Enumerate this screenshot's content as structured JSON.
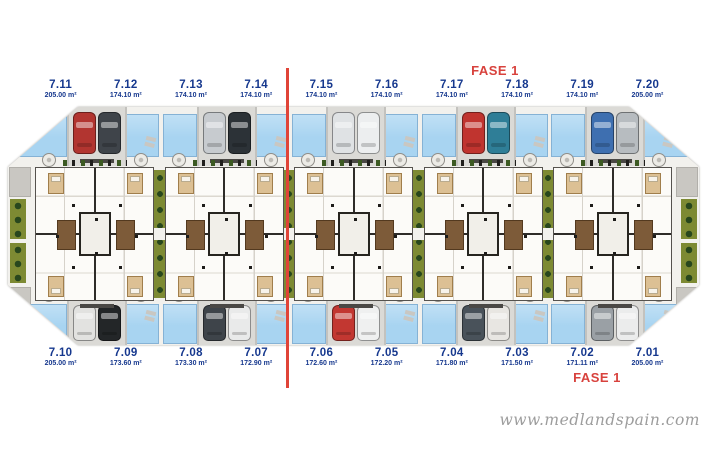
{
  "watermark": {
    "text": "www.medlandspain.com"
  },
  "phase": {
    "top": "FASE 1",
    "bottom": "FASE 1"
  },
  "colors": {
    "unit_label": "#16388e",
    "phase_text": "#d8423d",
    "phase_line": "#e04438",
    "pool": "#a8d4f1",
    "hedge": "#7d8a33",
    "plan_background": "#f2f1ed"
  },
  "blocks": {
    "count": 5
  },
  "units": {
    "top": [
      {
        "number": "7.11",
        "area": "205.00 m²"
      },
      {
        "number": "7.12",
        "area": "174.10 m²"
      },
      {
        "number": "7.13",
        "area": "174.10 m²"
      },
      {
        "number": "7.14",
        "area": "174.10 m²"
      },
      {
        "number": "7.15",
        "area": "174.10 m²"
      },
      {
        "number": "7.16",
        "area": "174.10 m²"
      },
      {
        "number": "7.17",
        "area": "174.10 m²"
      },
      {
        "number": "7.18",
        "area": "174.10 m²"
      },
      {
        "number": "7.19",
        "area": "174.10 m²"
      },
      {
        "number": "7.20",
        "area": "205.00 m²"
      }
    ],
    "bottom": [
      {
        "number": "7.10",
        "area": "205.00 m²"
      },
      {
        "number": "7.09",
        "area": "173.60 m²"
      },
      {
        "number": "7.08",
        "area": "173.30 m²"
      },
      {
        "number": "7.07",
        "area": "172.90 m²"
      },
      {
        "number": "7.06",
        "area": "172.60 m²"
      },
      {
        "number": "7.05",
        "area": "172.20 m²"
      },
      {
        "number": "7.04",
        "area": "171.80 m²"
      },
      {
        "number": "7.03",
        "area": "171.50 m²"
      },
      {
        "number": "7.02",
        "area": "171.11 m²"
      },
      {
        "number": "7.01",
        "area": "205.00 m²"
      }
    ]
  },
  "cars": {
    "top": [
      "#b23530",
      "#3f444a",
      "#c7cbcf",
      "#2c3237",
      "#dfe2e4",
      "#eceeef",
      "#c0342f",
      "#2f7e97",
      "#3e6fb0",
      "#b7bcc0"
    ],
    "bottom": [
      "#e2e2e0",
      "#232628",
      "#3e444a",
      "#e9eaea",
      "#c23731",
      "#eff0f0",
      "#49525a",
      "#e8e6e2",
      "#9aa0a5",
      "#ebecec"
    ]
  }
}
